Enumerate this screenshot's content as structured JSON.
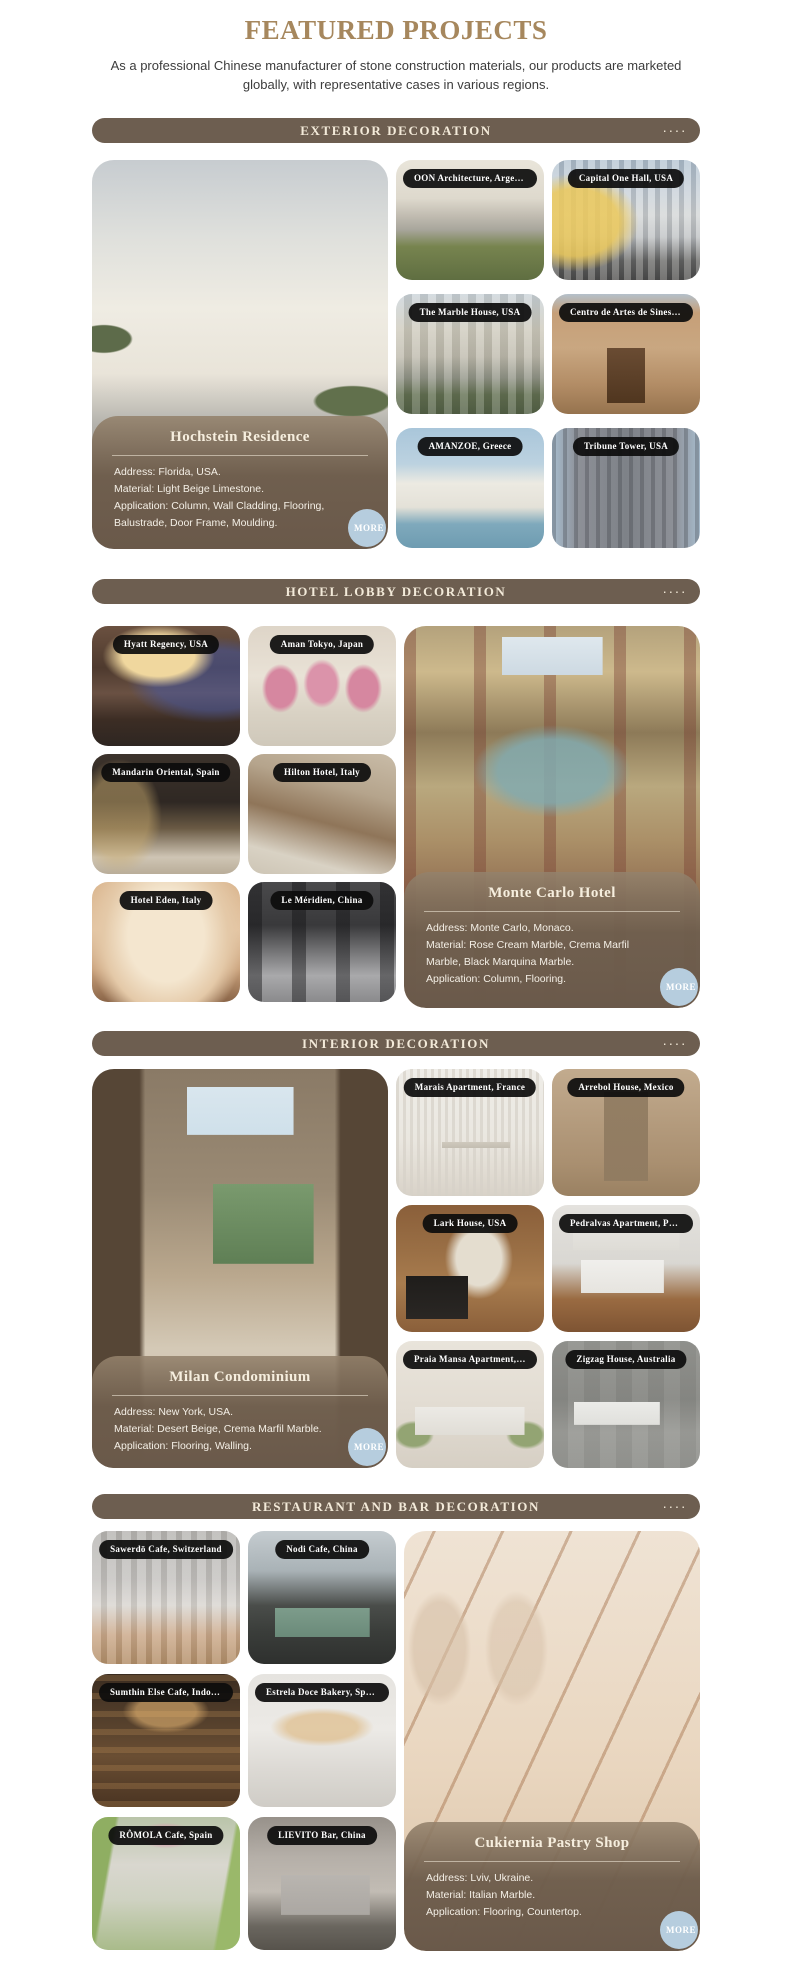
{
  "theme": {
    "accent_gold": "#a6875d",
    "bar_brown": "#6d5e50",
    "bar_text": "#f3ead9",
    "pill_bg": "#111111",
    "more_blue": "#b6cdde",
    "detail_text": "#f4efe6",
    "page_bg": "#ffffff"
  },
  "header": {
    "title": "FEATURED PROJECTS",
    "subtitle": "As a professional Chinese manufacturer of stone construction materials, our products are marketed globally, with representative cases in various regions."
  },
  "sections": [
    {
      "title": "EXTERIOR DECORATION",
      "dots": "····",
      "featured": {
        "name": "Hochstein Residence",
        "details": [
          "Address: Florida, USA.",
          "Material: Light Beige Limestone.",
          "Application: Column, Wall Cladding, Flooring,",
          "Balustrade, Door Frame, Moulding."
        ],
        "more_label": "MORE"
      },
      "cards": [
        {
          "label": "OON Architecture, Argentina"
        },
        {
          "label": "Capital One Hall, USA"
        },
        {
          "label": "The Marble House, USA"
        },
        {
          "label": "Centro de Artes de Sines, Portugal"
        },
        {
          "label": "AMANZOE, Greece"
        },
        {
          "label": "Tribune Tower, USA"
        }
      ]
    },
    {
      "title": "HOTEL LOBBY DECORATION",
      "dots": "····",
      "featured": {
        "name": "Monte Carlo Hotel",
        "details": [
          "Address: Monte Carlo, Monaco.",
          "Material: Rose Cream Marble, Crema Marfil",
          "Marble, Black Marquina Marble.",
          "Application: Column, Flooring."
        ],
        "more_label": "MORE"
      },
      "cards": [
        {
          "label": "Hyatt Regency, USA"
        },
        {
          "label": "Aman Tokyo, Japan"
        },
        {
          "label": "Mandarin Oriental, Spain"
        },
        {
          "label": "Hilton Hotel, Italy"
        },
        {
          "label": "Hotel Eden, Italy"
        },
        {
          "label": "Le Méridien, China"
        }
      ]
    },
    {
      "title": "INTERIOR DECORATION",
      "dots": "····",
      "featured": {
        "name": "Milan Condominium",
        "details": [
          "Address: New York, USA.",
          "Material: Desert Beige, Crema Marfil Marble.",
          "Application: Flooring, Walling."
        ],
        "more_label": "MORE"
      },
      "cards": [
        {
          "label": "Marais Apartment, France"
        },
        {
          "label": "Arrebol House, Mexico"
        },
        {
          "label": "Lark House, USA"
        },
        {
          "label": "Pedralvas Apartment, Portugal"
        },
        {
          "label": "Praia Mansa Apartment, Brazil"
        },
        {
          "label": "Zigzag House, Australia"
        }
      ]
    },
    {
      "title": "RESTAURANT AND BAR DECORATION",
      "dots": "····",
      "featured": {
        "name": "Cukiernia Pastry Shop",
        "details": [
          "Address: Lviv, Ukraine.",
          "Material: Italian Marble.",
          "Application: Flooring, Countertop."
        ],
        "more_label": "MORE"
      },
      "cards": [
        {
          "label": "Sawerdō Cafe, Switzerland"
        },
        {
          "label": "Nodi Cafe, China"
        },
        {
          "label": "Sumthin Else Cafe, Indonesia"
        },
        {
          "label": "Estrela Doce Bakery, Spain"
        },
        {
          "label": "RÔMOLA Cafe, Spain"
        },
        {
          "label": "LIEVITO Bar, China"
        }
      ]
    }
  ]
}
